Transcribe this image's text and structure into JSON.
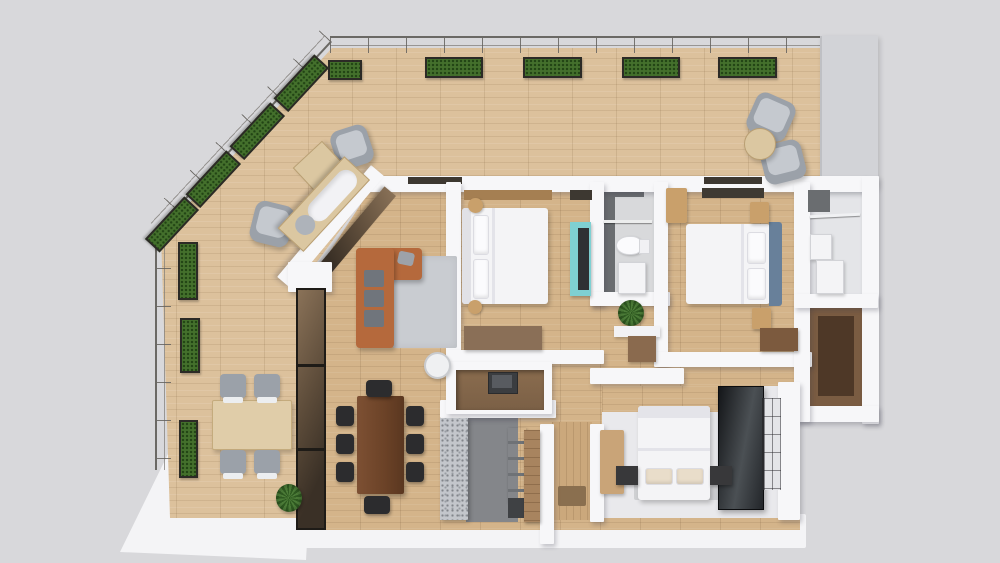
{
  "image": {
    "kind": "3d-floor-plan-render",
    "description": "Top-down 3D render of an apartment with wrap-around terrace, living-dining area, kitchen and three bedrooms",
    "width_px": 1000,
    "height_px": 563
  },
  "palette": {
    "background": "#d8d8db",
    "slab_white": "#f4f4f6",
    "wall_white": "#f7f7f9",
    "terrace_wood": "#dcc19c",
    "interior_wood": "#d4b48a",
    "entry_wood": "#cba87c",
    "railing_line": "#6b6965",
    "planter_green": "#44702c",
    "planter_box": "#2c2a26",
    "terrace_side_wall": "#d2d3d7",
    "sofa_orange": "#b5693c",
    "cushion_gray": "#70757c",
    "rug_gray": "#c9ccd1",
    "light_wood": "#dbc7a1",
    "walnut": "#6b4227",
    "chair_gray": "#9ba1a9",
    "chair_black": "#2c2c2e",
    "bed_white": "#f4f4f6",
    "headboard_blue": "#68809a",
    "nightstand_tan": "#c9a06b",
    "tv_teal": "#7fd0d2",
    "marble_gray": "#6a6d70",
    "bath_floor": "#d8d9db",
    "granite_gray": "#c3c6cb",
    "kitchen_floor": "#84868a",
    "appliance_dark": "#3f4144",
    "cabinet_wood": "#a8845f",
    "bronze_light": "#8a7258",
    "bronze_dark": "#3a3026",
    "wardrobe_brown": "#7a5c42",
    "wardrobe_inner": "#4e3827",
    "plant_green": "#4c7c38",
    "pale_floor": "#e9e9ec",
    "window_gray": "#e4e5e8",
    "mat_brown": "#8a6f4f",
    "dresser_brown": "#8a6f57",
    "desk_brown": "#7c5a3e",
    "niche_wood": "#7b6046",
    "beige_pillow": "#e9ddca"
  },
  "rooms": [
    {
      "name": "terrace"
    },
    {
      "name": "living-room"
    },
    {
      "name": "dining-area"
    },
    {
      "name": "kitchen"
    },
    {
      "name": "entry-hall"
    },
    {
      "name": "bedroom-1"
    },
    {
      "name": "bathroom"
    },
    {
      "name": "hallway"
    },
    {
      "name": "bedroom-2"
    },
    {
      "name": "walk-in-closet"
    },
    {
      "name": "wardrobe-nook"
    },
    {
      "name": "bedroom-3"
    }
  ],
  "furniture": {
    "terrace": [
      "glass-railing",
      "planter-boxes",
      "armchairs",
      "square-coffee-table",
      "daybed",
      "round-side-table",
      "outdoor-dining-table",
      "outdoor-chairs",
      "potted-plant"
    ],
    "living_room": [
      "l-shaped-sofa",
      "gray-cushions",
      "area-rug",
      "side-stool",
      "media-niche-with-monitor",
      "bronze-glass-partition"
    ],
    "dining_area": [
      "walnut-dining-table",
      "black-dining-chairs-x8"
    ],
    "kitchen": [
      "granite-island",
      "stainless-appliance-column",
      "wood-cabinet-panel"
    ],
    "bedroom_1": [
      "double-bed-white",
      "wood-headboard-band",
      "teal-tv-sideboard",
      "foot-dresser",
      "round-poufs"
    ],
    "bathroom": [
      "marble-wall",
      "shower-rail",
      "toilet",
      "vanity",
      "plant"
    ],
    "bedroom_2": [
      "double-bed-blue-headboard",
      "nightstands-tan",
      "corner-wardrobe",
      "desk"
    ],
    "walk_in_closet": [
      "hanging-rail",
      "storage-boxes"
    ],
    "wardrobe_nook": [
      "built-in-wardrobe"
    ],
    "bedroom_3": [
      "double-bed-white",
      "beige-pillows",
      "dark-nightstands",
      "tan-dresser",
      "dark-glass-wardrobe",
      "window"
    ],
    "entry_hall": [
      "door-mat"
    ]
  }
}
